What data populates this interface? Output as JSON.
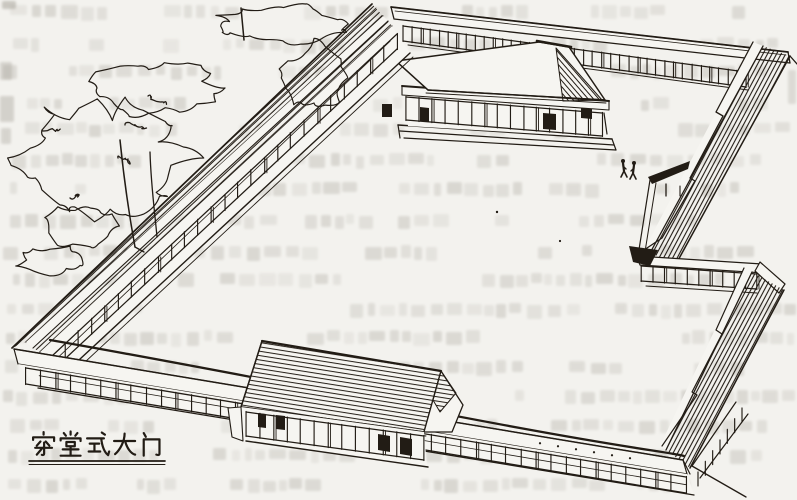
{
  "figure": {
    "caption": "穿堂式大门",
    "scene": {
      "description": "hand-drawn perspective of a walled courtyard compound",
      "main_hall": "hip-roofed hall on a platform inside the courtyard",
      "gate": "passage-hall style gate building on the front wall",
      "corridor_walls": 4,
      "trees": "scribbled foliage at the upper left",
      "people_count": 2
    }
  },
  "palette": {
    "paper": "#f3f2ee",
    "paper_light": "#f6f5f1",
    "ink": "#221c15",
    "bleedthrough": "#a9a59c"
  }
}
